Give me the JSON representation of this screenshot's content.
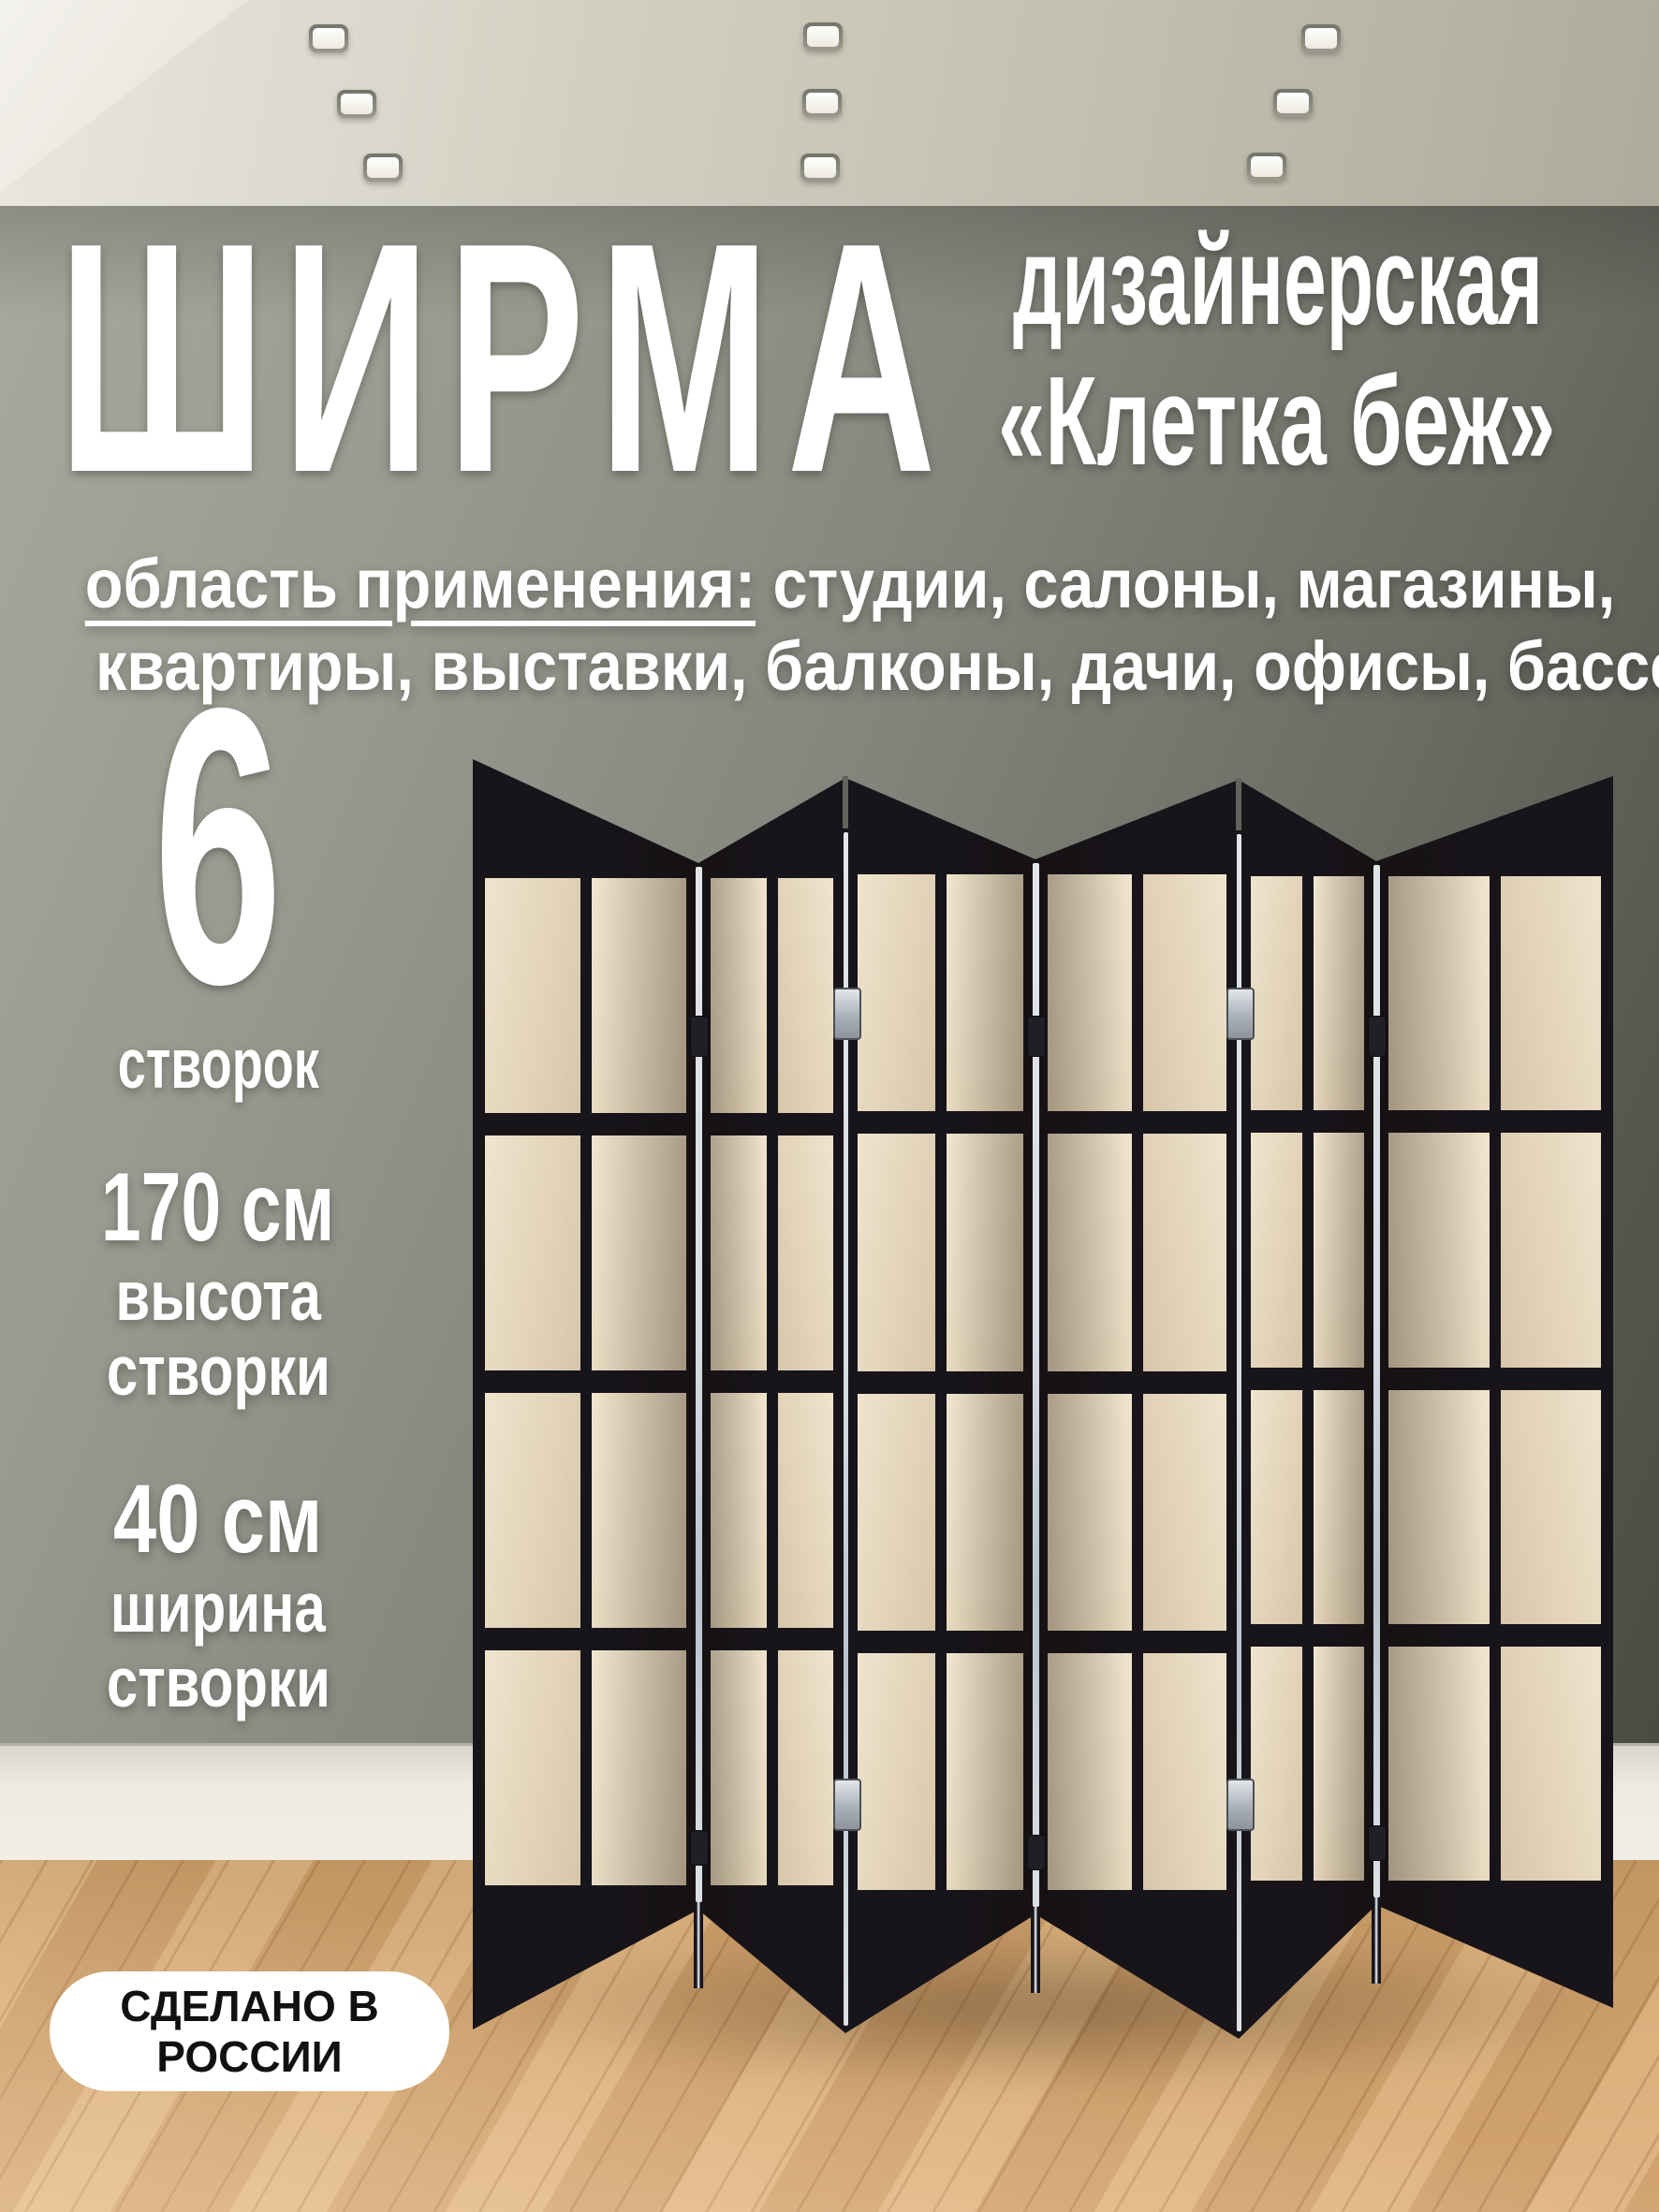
{
  "product": {
    "title": "ШИРМА",
    "subtitle_line1": "дизайнерская",
    "subtitle_line2": "«Клетка беж»",
    "applications_label": "область применения:",
    "applications_line1_rest": " студии, салоны, магазины,",
    "applications_line2": "квартиры, выставки, балконы, дачи, офисы, бассейны",
    "specs": [
      {
        "value": "6",
        "label_lines": [
          "створок"
        ]
      },
      {
        "value": "170 см",
        "label_lines": [
          "высота",
          "створки"
        ]
      },
      {
        "value": "40 см",
        "label_lines": [
          "ширина",
          "створки"
        ]
      }
    ],
    "badge_line1": "СДЕЛАНО В",
    "badge_line2": "РОССИИ"
  },
  "screen": {
    "panel_count": 6,
    "grid_rows": 4,
    "grid_cols": 2,
    "frame_color": "#17141a",
    "panel_fill_light": "#f0e4cd",
    "panel_fill_dark": "#d7c6aa",
    "hinge_color": "#c6ccd3",
    "fold_highlight_color": "#e8eff6"
  },
  "room": {
    "ceiling_light_count": 9,
    "wall_color_light": "#a3a69b",
    "wall_color_dark": "#4b4c44",
    "baseboard_color": "#ece7df",
    "floor_color": "#d2a470"
  }
}
